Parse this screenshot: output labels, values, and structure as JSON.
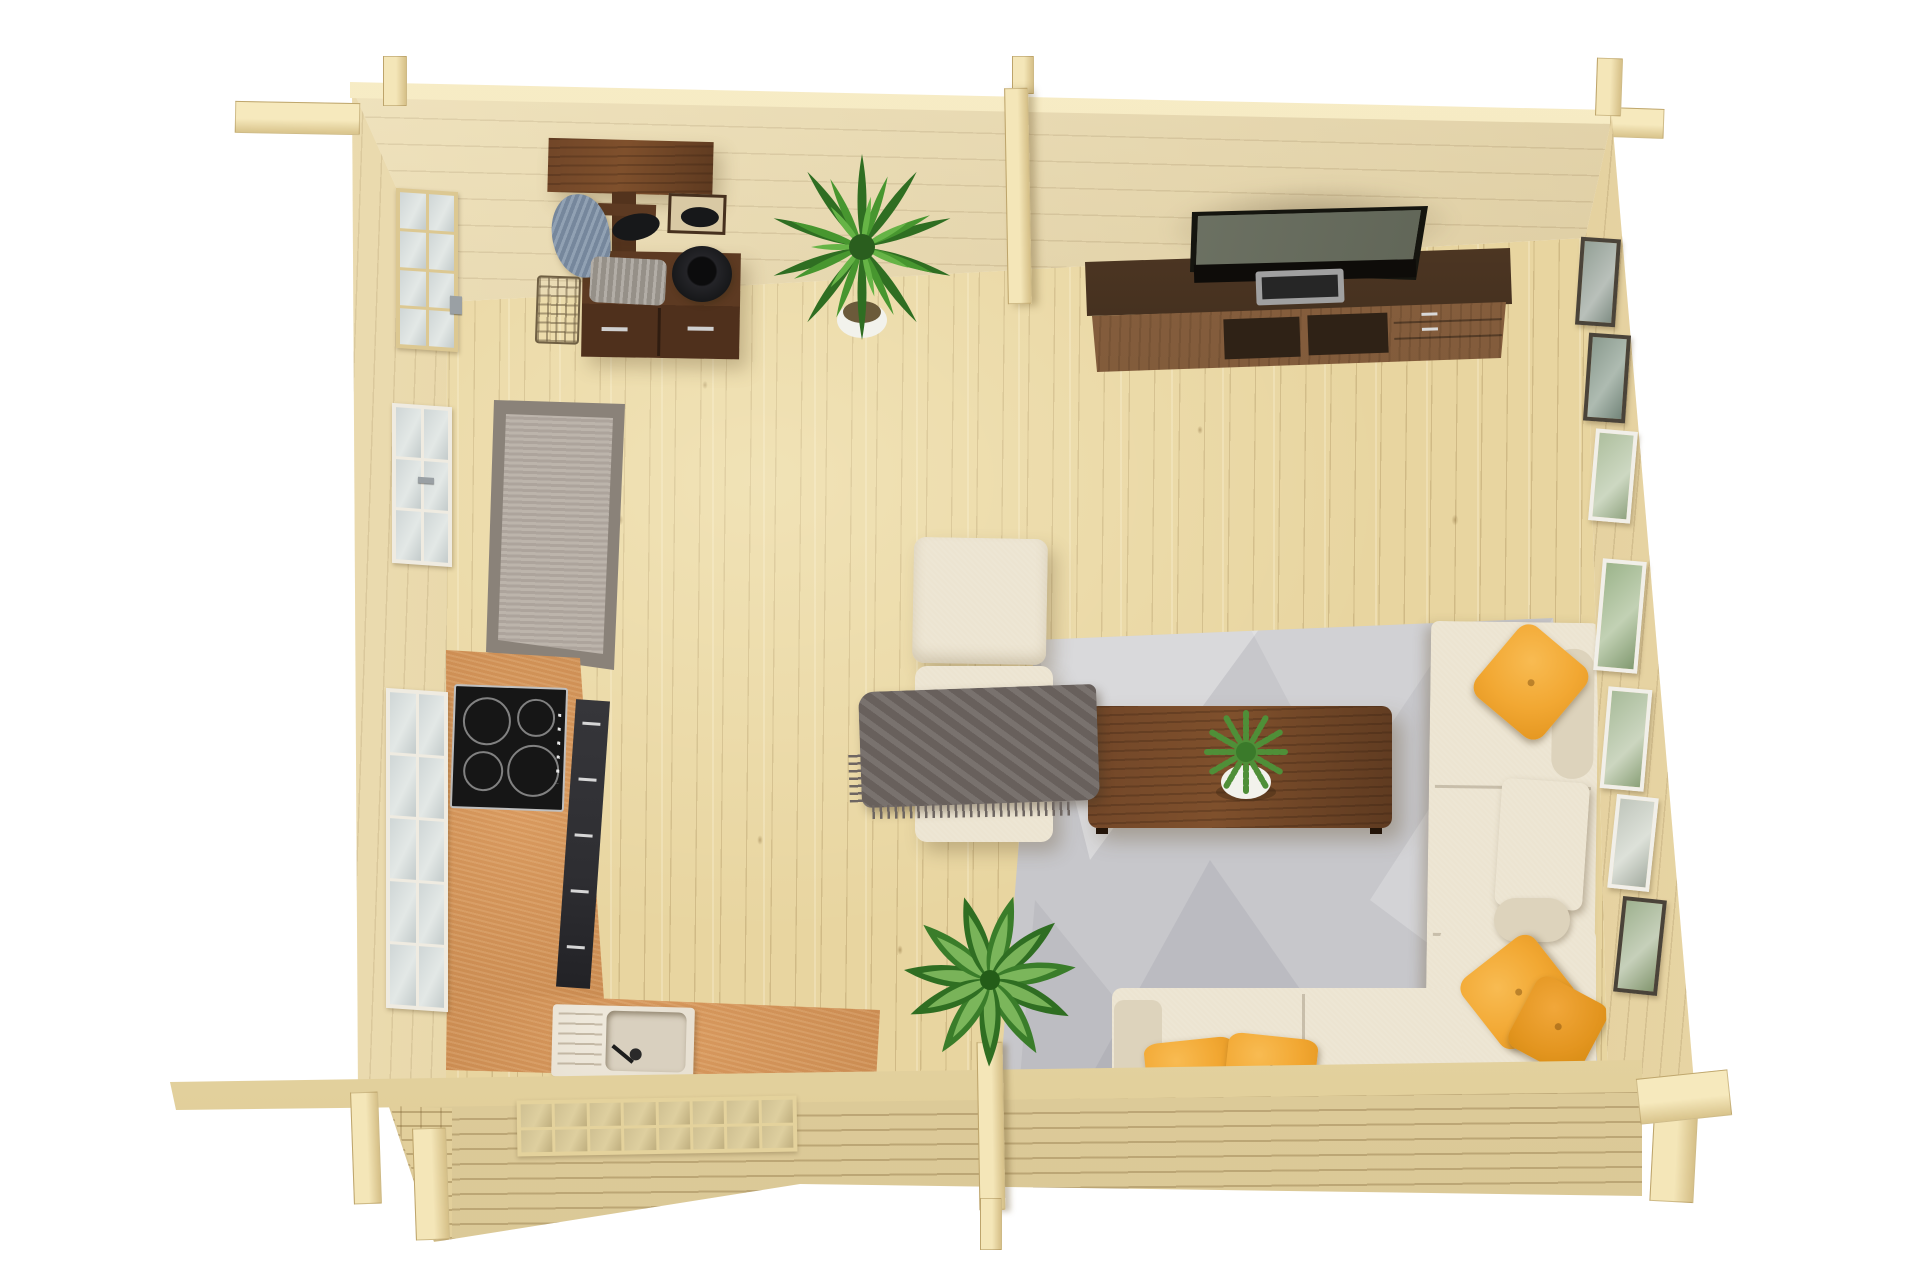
{
  "scene": {
    "type": "photoreal 3d render, top-down view",
    "subject": "log cabin interior floor plan with open-plan kitchen and living room",
    "background": "#ffffff"
  },
  "colors": {
    "bg": "#ffffff",
    "floor_wood": "#e8d5a0",
    "wall_top": "#ecd9a6",
    "wall_left": "#ead7a4",
    "wall_right": "#e5cf97",
    "log_band": "#e9d8a6",
    "beam": "#f2e4b6",
    "counter": "#c98a50",
    "hob": "#161616",
    "hob_ring": "#d8d8d8",
    "cabinet": "#2e2e32",
    "cabinet_handle": "#d6d6d6",
    "sink": "#e8e1d3",
    "sink_basin": "#d9d0bf",
    "runner_border": "#8a8279",
    "runner_field": "#b4aba2",
    "area_rug": "#c7c7cb",
    "sofa": "#ece4d1",
    "sofa_shade": "#ddd3bc",
    "pillow": "#f2a833",
    "pillow_deep": "#e3951f",
    "throw": "#6e6662",
    "table": "#6b4124",
    "console_back": "#3f2c1d",
    "console_front": "#7a5536",
    "console_shelf": "#2f2216",
    "tv_bezel": "#15150f",
    "tv_screen": "#5d6254",
    "soundbar": "#a0a0a0",
    "soundbar_slot": "#262626",
    "glass": "#ccd3d3",
    "window_frame": "#efebe1",
    "door_frame": "#dcc892",
    "frame_dark": "#4a4339",
    "frame_white": "#f1efe9",
    "plant_dark": "#2f6e22",
    "plant_mid": "#47962f",
    "plant_light": "#66b446",
    "leaf_vein": "#8cc468",
    "fern": "#4f8f38",
    "pot_white": "#f2f2ec",
    "hall_walnut": "#5d3a22",
    "bench_front": "#4f301c",
    "coat_blue": "#8294a9",
    "hat_black": "#17181a",
    "towel_gray": "#a59f97"
  },
  "objects": [
    {
      "name": "log-walls",
      "color": "#ecd9a6"
    },
    {
      "name": "pine-plank-floor",
      "color": "#e8d5a0"
    },
    {
      "name": "glazed-entry-door",
      "color": "#dcc892"
    },
    {
      "name": "left-wall-window-upper",
      "color": "#efebe1"
    },
    {
      "name": "left-wall-window-lower",
      "color": "#efebe1"
    },
    {
      "name": "front-wall-window",
      "color": "#e4d29c"
    },
    {
      "name": "entry-runner-rug",
      "color": "#b4aba2"
    },
    {
      "name": "hall-tree-with-bench",
      "color": "#5d3a22"
    },
    {
      "name": "hanging-coat",
      "color": "#8294a9"
    },
    {
      "name": "black-hats",
      "color": "#17181a"
    },
    {
      "name": "wire-basket",
      "color": "#6f5f43"
    },
    {
      "name": "folded-blanket",
      "color": "#a59f97"
    },
    {
      "name": "palm-plant",
      "color": "#47962f"
    },
    {
      "name": "kitchen-counter-l-shape",
      "color": "#c98a50"
    },
    {
      "name": "induction-hob",
      "color": "#161616"
    },
    {
      "name": "base-cabinets",
      "color": "#2e2e32"
    },
    {
      "name": "kitchen-sink",
      "color": "#e8e1d3"
    },
    {
      "name": "tv-console",
      "color": "#7a5536"
    },
    {
      "name": "flatscreen-tv",
      "color": "#15150f"
    },
    {
      "name": "soundbar",
      "color": "#a0a0a0"
    },
    {
      "name": "gallery-picture-frames",
      "color": "#f1efe9"
    },
    {
      "name": "living-area-rug",
      "color": "#c7c7cb"
    },
    {
      "name": "sectional-sofa",
      "color": "#ece4d1"
    },
    {
      "name": "yellow-cushions",
      "color": "#f2a833"
    },
    {
      "name": "lounge-chair",
      "color": "#ece4d1"
    },
    {
      "name": "gray-throw-blanket",
      "color": "#6e6662"
    },
    {
      "name": "walnut-coffee-table",
      "color": "#6b4124"
    },
    {
      "name": "fern-centerpiece",
      "color": "#4f8f38"
    },
    {
      "name": "dieffenbachia-plant",
      "color": "#2f6e22"
    }
  ]
}
